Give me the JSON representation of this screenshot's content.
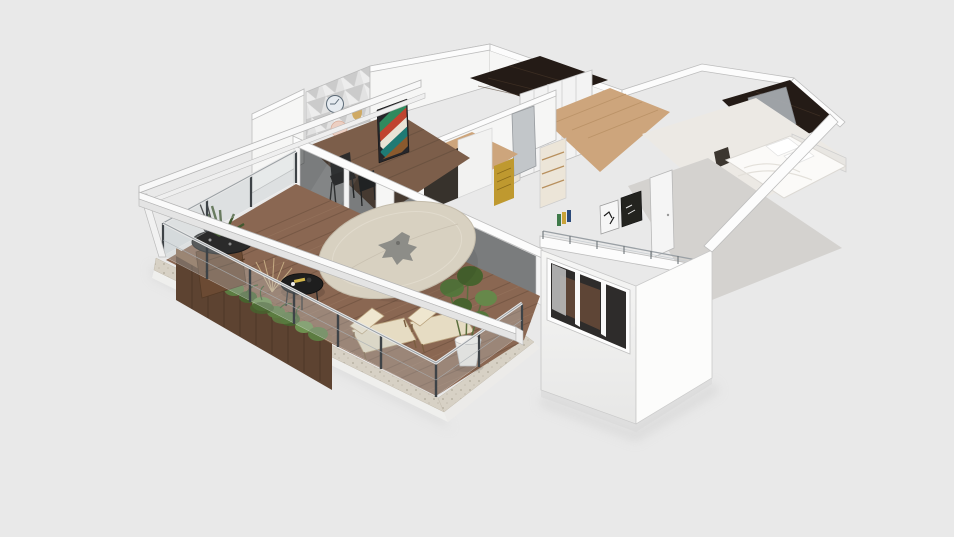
{
  "viewport": {
    "width": 954,
    "height": 537,
    "background": "#e9e9e9"
  },
  "colors": {
    "bg": "#e9e9e9",
    "wall": "#f6f6f5",
    "wall-top": "#fcfcfc",
    "wall-shade": "#e6e6e4",
    "line": "#bdbdbd",
    "marble": "#241b16",
    "wood": "#cda57c",
    "deck": "#8a6752",
    "deck-gap": "#6f5340",
    "deck-hi": "#9b7a62",
    "stone": "#d7d1c5",
    "planter": "#5d4331",
    "plant": "#5c7c41",
    "plant-dark": "#47632e",
    "glass-int": "rgba(22,24,27,0.52)",
    "rail-glass": "rgba(195,205,210,0.30)",
    "parasol": "#d8d1c1",
    "floor-gray": "#d4d2cf"
  },
  "scene": {
    "view": "isometric-3d-floor-plan",
    "objects": [
      "terrace-deck",
      "glass-railing",
      "pergola-beams",
      "round-parasol",
      "lounge-chairs",
      "coffee-table",
      "wood-planters",
      "agave-bowl",
      "potted-plant",
      "white-stairs",
      "sliding-glass-wall",
      "dining-room",
      "accent-wall",
      "wall-clock",
      "striped-painting",
      "kitchen",
      "wardrobe-closet",
      "hallway",
      "marble-bathroom",
      "marble-bathroom-right",
      "master-bed",
      "lower-bedroom",
      "interior-door",
      "wall-art",
      "exterior-window-wall",
      "triple-pane-window"
    ]
  }
}
